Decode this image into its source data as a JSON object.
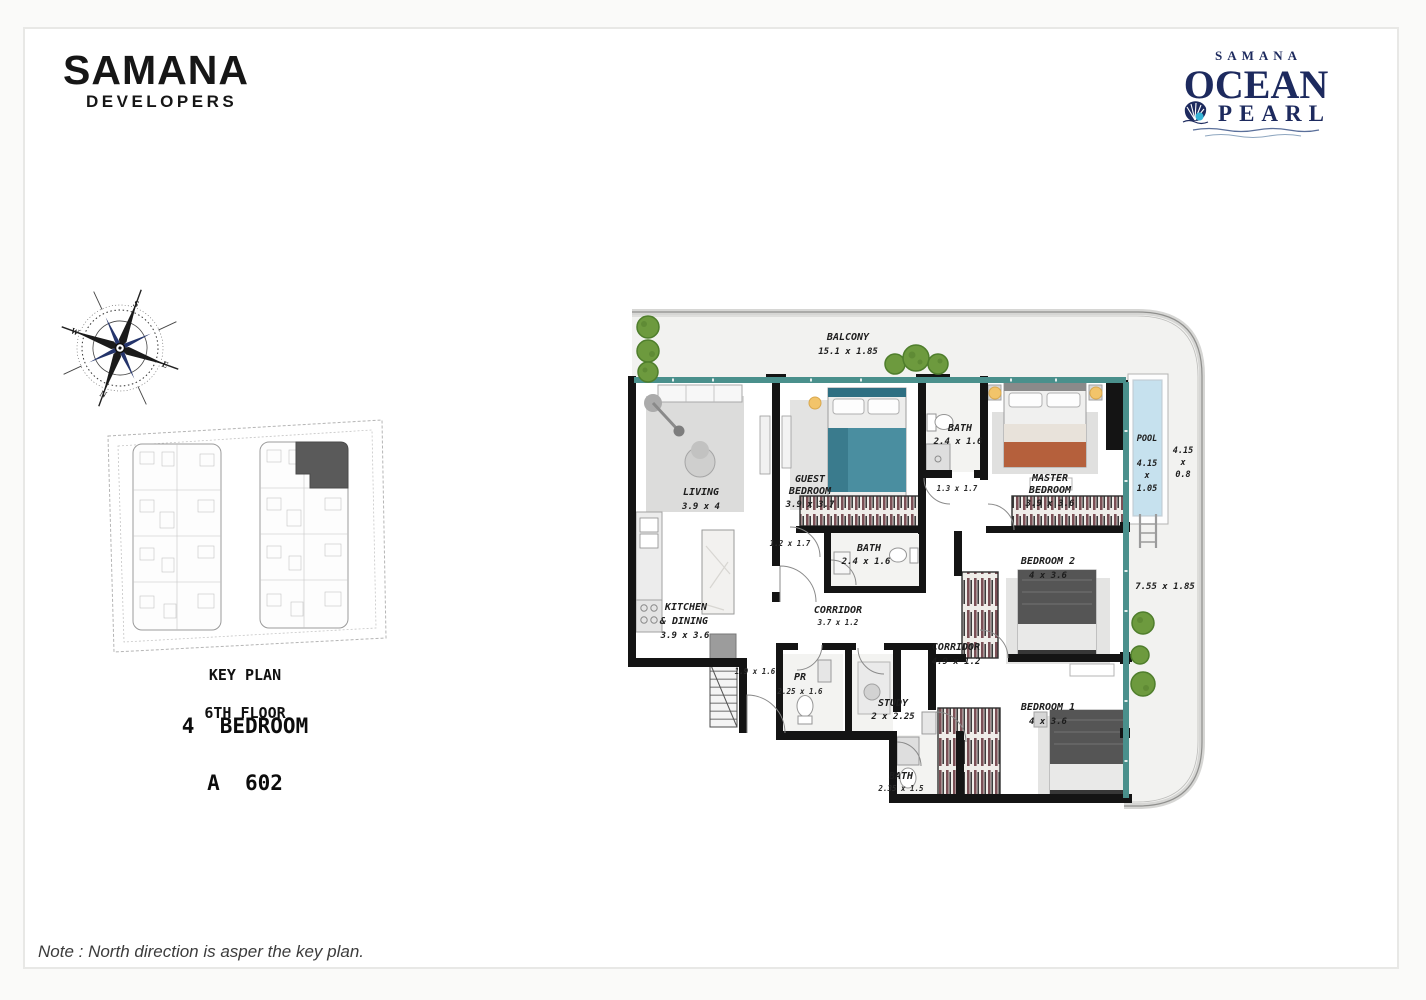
{
  "branding": {
    "developer": {
      "name": "SAMANA",
      "tagline": "DEVELOPERS"
    },
    "project": {
      "brand": "SAMANA",
      "title_top": "OCEAN",
      "title_bottom": "PEARL"
    }
  },
  "key_plan": {
    "heading_line1": "KEY PLAN",
    "heading_line2": "6TH FLOOR",
    "unit_type": "4  BEDROOM",
    "unit_code": "A  602"
  },
  "compass": {
    "north": "N",
    "south": "S",
    "east": "E",
    "west": "W"
  },
  "plan": {
    "balcony": {
      "name": "BALCONY",
      "dims": "15.1 x 1.85"
    },
    "living": {
      "name": "LIVING",
      "dims": "3.9 x 4"
    },
    "guest_bedroom": {
      "line1": "GUEST",
      "line2": "BEDROOM",
      "dims": "3.9 x 3.7"
    },
    "bath_top": {
      "name": "BATH",
      "dims": "2.4 x 1.6"
    },
    "master_bedroom": {
      "line1": "MASTER",
      "line2": "BEDROOM",
      "dims": "3.9 x 3.6"
    },
    "pool": {
      "name": "POOL",
      "w": "4.15",
      "x": "x",
      "l": "1.05"
    },
    "pool_deck": {
      "w": "4.15",
      "x": "x",
      "l": "0.8"
    },
    "bedroom_2": {
      "name": "BEDROOM 2",
      "dims": "4 x 3.6"
    },
    "bath_mid": {
      "name": "BATH",
      "dims": "2.4 x 1.6"
    },
    "corridor_main": {
      "name": "CORRIDOR",
      "dims": "3.7 x 1.2"
    },
    "corridor_right": {
      "name": "CORRIDOR",
      "dims": "4.9 x 1.2"
    },
    "kitchen": {
      "line1": "KITCHEN",
      "line2": "& DINING",
      "dims": "3.9 x 3.6"
    },
    "pr": {
      "name": "PR",
      "dims": "2.25 x 1.6"
    },
    "study": {
      "name": "STUDY",
      "dims": "2 x 2.25"
    },
    "bedroom_1": {
      "name": "BEDROOM 1",
      "dims": "4 x 3.6"
    },
    "bath_bottom": {
      "name": "BATH",
      "dims": "2.35 x 1.5"
    },
    "terrace_dims": "7.55 x 1.85",
    "foyer_dims": "1.9 x 1.6",
    "hall_dims_1": "1.2 x 1.7",
    "hall_dims_2": "1.3 x 1.7"
  },
  "note": "Note : North direction is asper the key plan.",
  "colors": {
    "navy": "#1d2a5e",
    "pearl_cyan": "#35b4d6",
    "window_teal": "#4a908c",
    "wall_black": "#141414",
    "pool_fill": "#c6e1ee",
    "tree_green": "#6d9a3e"
  }
}
